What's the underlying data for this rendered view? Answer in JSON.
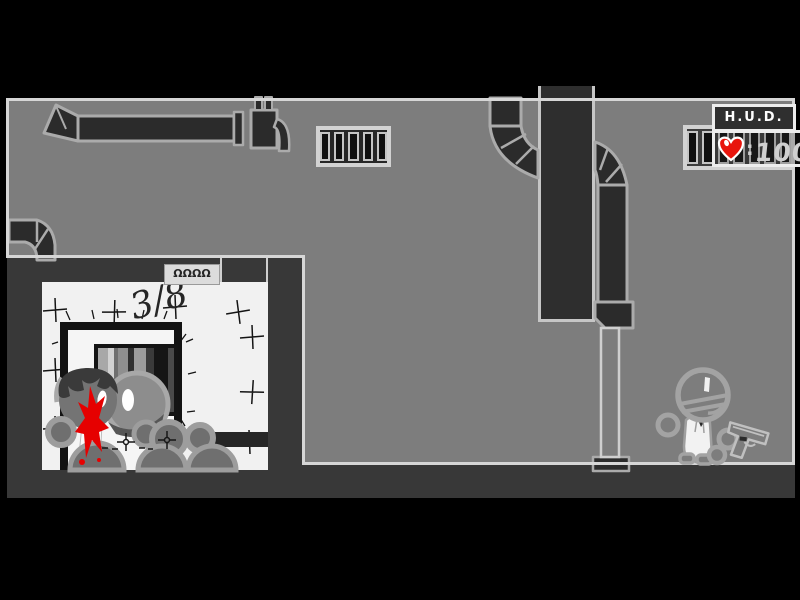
{
  "hud": {
    "title": "H.U.D.",
    "health": {
      "separator": ":",
      "value": "100",
      "icon": "heart-icon",
      "heart_color": "#e8150d"
    }
  },
  "room": {
    "graffiti": "3/8",
    "plaque": "ΩΩΩΩ"
  },
  "colors": {
    "background": "#000000",
    "wall_light": "#7d7d7d",
    "wall_dark": "#2e2e2e",
    "underfloor_dark": "#383838",
    "room_white": "#f1f1f1",
    "outline_light": "#d6d6d6",
    "duct_outline": "#ababab",
    "blood_red": "#e60000",
    "heart_red": "#e8150d",
    "hud_border": "#ededed",
    "hud_text": "#ffffff",
    "health_text": "#cfcfcf"
  }
}
